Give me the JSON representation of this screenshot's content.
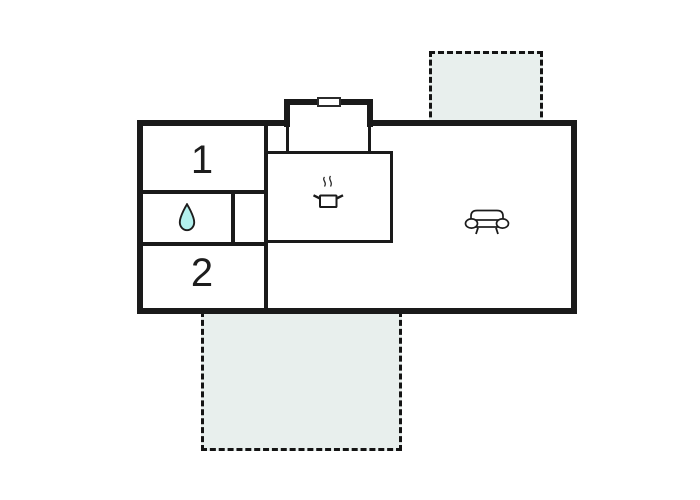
{
  "plan": {
    "type": "floor-plan",
    "palette": {
      "wall_color": "#1a1a1a",
      "background": "#ffffff",
      "terrace_fill": "#e8efed",
      "water_drop_fill": "#b3f1ee"
    },
    "rooms": {
      "bedroom1": {
        "label": "1"
      },
      "bedroom2": {
        "label": "2"
      },
      "bathroom": {
        "icon": "water-drop-icon"
      },
      "kitchen": {
        "icon": "cooking-pot-icon"
      },
      "living_room": {
        "icon": "sofa-icon"
      },
      "entrance": {
        "feature": "door"
      }
    },
    "terraces": [
      {
        "id": "terrace-top-right"
      },
      {
        "id": "terrace-bottom"
      }
    ]
  }
}
